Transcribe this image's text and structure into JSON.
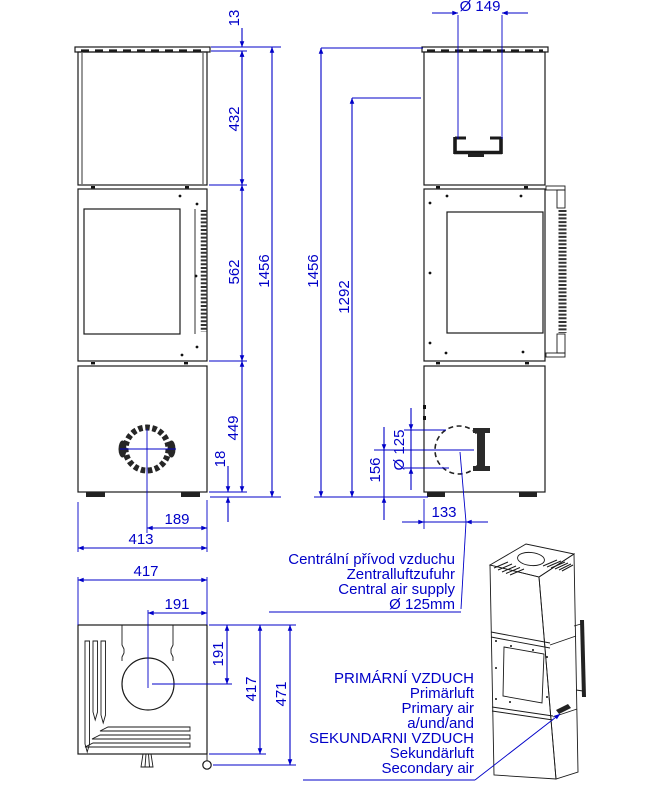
{
  "drawing": {
    "type": "stove technical drawing, three orthographic views plus perspective view",
    "colors": {
      "dimension_blue": "#0000c8",
      "line_black": "#1a1a1a",
      "background": "#ffffff"
    }
  },
  "front_view": {
    "dim_top_plate": "13",
    "dim_upper_block": "432",
    "dim_middle_block": "562",
    "dim_lower_block": "449",
    "dim_foot_height": "18",
    "dim_total_height": "1456",
    "dim_inlet_offset": "189",
    "dim_body_width": "413"
  },
  "side_view": {
    "dim_flue_diameter": "Ø 149",
    "dim_total_height": "1456",
    "dim_flue_axis_height": "1292",
    "dim_inlet_diameter": "Ø 125",
    "dim_inlet_height": "156",
    "dim_inlet_depth": "133"
  },
  "bottom_view": {
    "dim_width": "417",
    "dim_inlet_offset_x": "191",
    "dim_inlet_offset_y": "191",
    "dim_depth": "417",
    "dim_total_depth": "471"
  },
  "annotations": {
    "central_air": [
      "Centrální přívod vzduchu",
      "Zentralluftzufuhr",
      "Central air supply",
      "Ø 125mm"
    ],
    "combustion_air": [
      "PRIMÁRNÍ VZDUCH",
      "Primärluft",
      "Primary air",
      "a/und/and",
      "SEKUNDARNI VZDUCH",
      "Sekundärluft",
      "Secondary air"
    ]
  }
}
